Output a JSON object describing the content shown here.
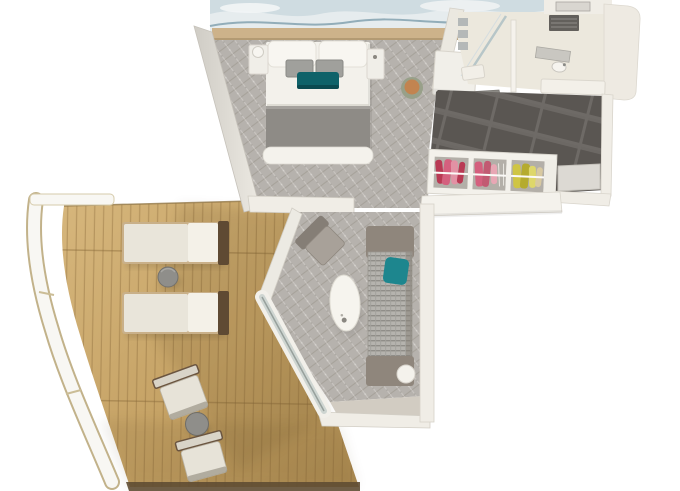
{
  "meta": {
    "render_type": "3d-floorplan-top-view",
    "subject": "suite-with-wraparound-balcony"
  },
  "palette": {
    "background": "#ffffff",
    "wall": "#f0ede6",
    "wall_shade": "#d6d2c9",
    "deck_light": "#d6b67c",
    "deck_dark": "#aa8950",
    "plank_line": "#8a6a3a",
    "carpet": "#b6b2ad",
    "carpet_dark": "#908c87",
    "carpet_light": "#dbd8d3",
    "tile_dark": "#5a5652",
    "tile_light": "#6e6a66",
    "bedding_white": "#f3f1eb",
    "blanket_gray": "#8e8b86",
    "pillow_gray": "#a0a09c",
    "accent_teal": "#0e6269",
    "sofa_teal": "#1d868e",
    "sofa_frame": "#8f867c",
    "lounger_cushion": "#e9e5da",
    "lounger_frame": "#5f4a33",
    "stool_green": "#98a089",
    "stool_top": "#c28450",
    "clothes_pink": "#d4607e",
    "clothes_red": "#b93a54",
    "clothes_yellow": "#cfc544",
    "art_blue": "#cfdce1",
    "art_line": "#7d9dab",
    "ledge_tan": "#cdb28a",
    "bath_floor": "#ece8dd",
    "table_gray": "#8f8e8a",
    "floor_greige": "#d2ccc2",
    "fascia": "#5f4c33",
    "railing_white": "#f8f7f3",
    "railing_trim": "#c2b28a"
  },
  "rooms": [
    {
      "id": "bedroom",
      "furniture": [
        "king-bed",
        "pillows",
        "nightstand-left",
        "nightstand-right",
        "art-mural-wall",
        "headboard-ledge",
        "vanity-desk",
        "stool",
        "entry-mat",
        "shoes"
      ]
    },
    {
      "id": "bathroom",
      "furniture": [
        "shower",
        "shower-glass",
        "partition",
        "vanity-counter",
        "sink",
        "ceiling-vent",
        "bench"
      ]
    },
    {
      "id": "entry-hall",
      "furniture": [
        "dark-tile-floor",
        "wardrobe",
        "wardrobe-clothes",
        "counter",
        "entrance-door"
      ]
    },
    {
      "id": "living-room",
      "furniture": [
        "sofa",
        "teal-throw-pillow",
        "coffee-table",
        "armchair",
        "side-table",
        "sliding-glass-door"
      ]
    },
    {
      "id": "balcony",
      "furniture": [
        "sun-lounger-1",
        "sun-lounger-2",
        "lounger-side-table",
        "dining-chair-1",
        "dining-chair-2",
        "balcony-table",
        "curved-railing",
        "wood-deck"
      ]
    }
  ]
}
